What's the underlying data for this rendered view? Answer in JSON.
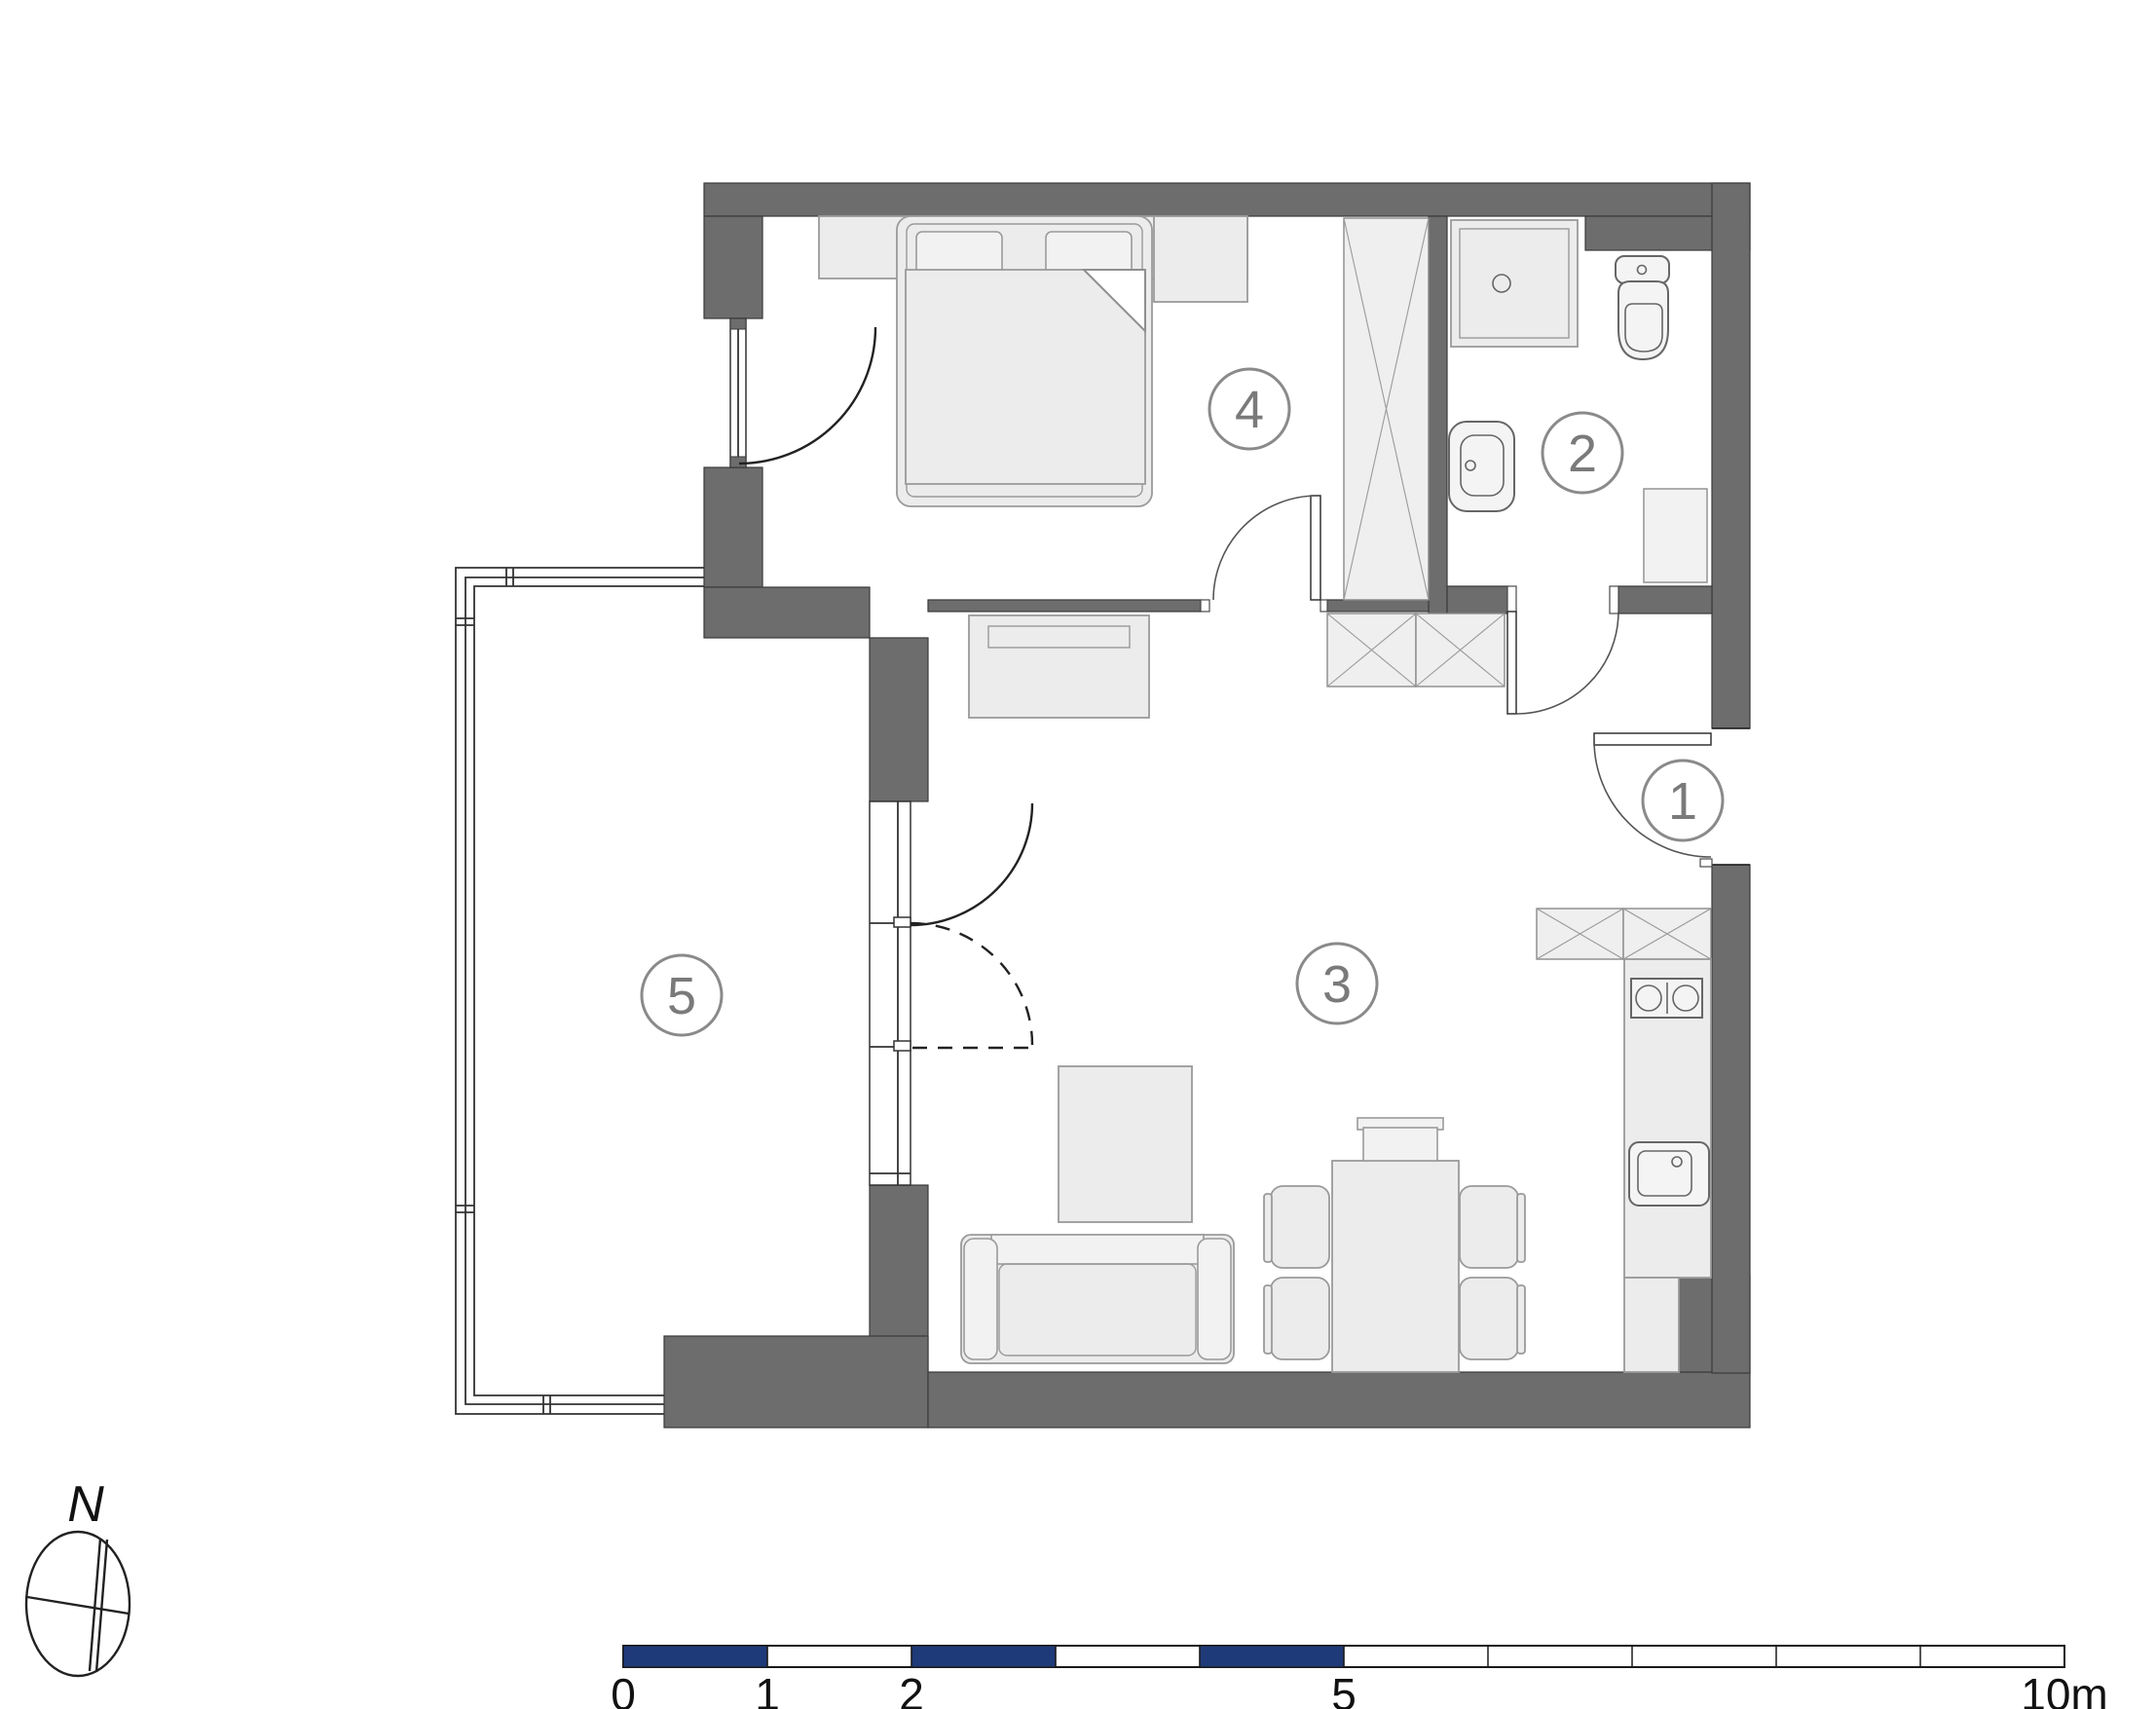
{
  "colors": {
    "wall": "#6d6d6d",
    "wall_edge": "#3a3a3a",
    "furniture_fill": "#ececec",
    "furniture_fill_light": "#f2f2f2",
    "furniture_stroke": "#9a9a9a",
    "fixture_stroke": "#666666",
    "door_line": "#2f2f2f",
    "swing_line": "#555555",
    "label_stroke": "#8a8a8a",
    "label_text": "#7a7a7a",
    "scale_navy": "#1e3a78",
    "scale_text": "#111111",
    "compass_line": "#222222",
    "background": "#ffffff"
  },
  "labels": {
    "rooms": [
      "1",
      "2",
      "3",
      "4",
      "5"
    ],
    "compass_north": "N",
    "scale_ticks": [
      "0",
      "1",
      "2",
      "5",
      "10m"
    ]
  }
}
